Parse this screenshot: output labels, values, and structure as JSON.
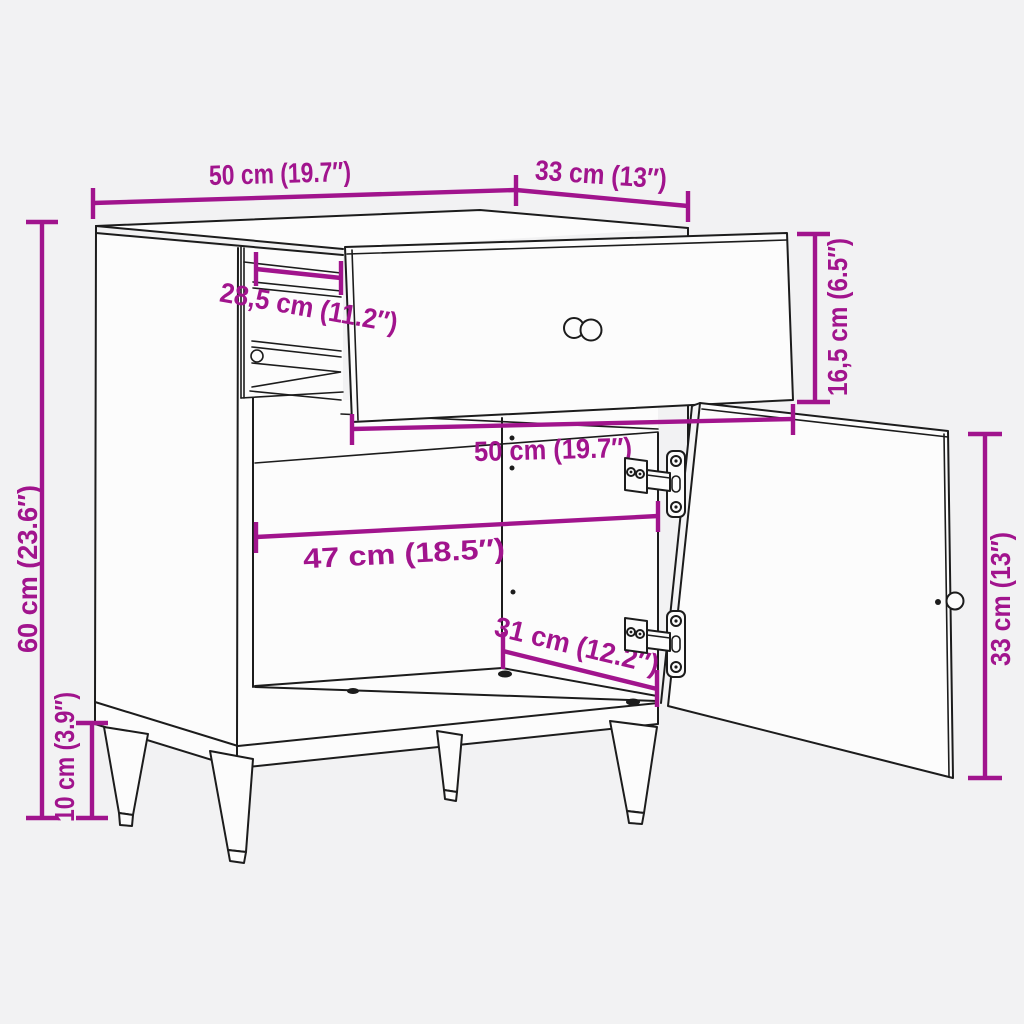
{
  "diagram": {
    "kind": "furniture dimension line drawing",
    "colors": {
      "background": "#F2F2F3",
      "face": "#FCFCFC",
      "face_shaded": "#F4F4F5",
      "line": "#1C1C1C",
      "dimension": "#A1148D"
    },
    "labels": {
      "top_width": "50 cm (19.7″)",
      "top_depth": "33 cm (13″)",
      "height": "60 cm (23.6″)",
      "leg_height": "10 cm (3.9″)",
      "slide_length": "28,5 cm (11.2″)",
      "drawer_width": "50 cm (19.7″)",
      "interior_width": "47 cm (18.5″)",
      "interior_depth": "31 cm (12.2″)",
      "drawer_height": "16,5 cm (6.5″)",
      "door_height": "33 cm (13″)"
    }
  }
}
